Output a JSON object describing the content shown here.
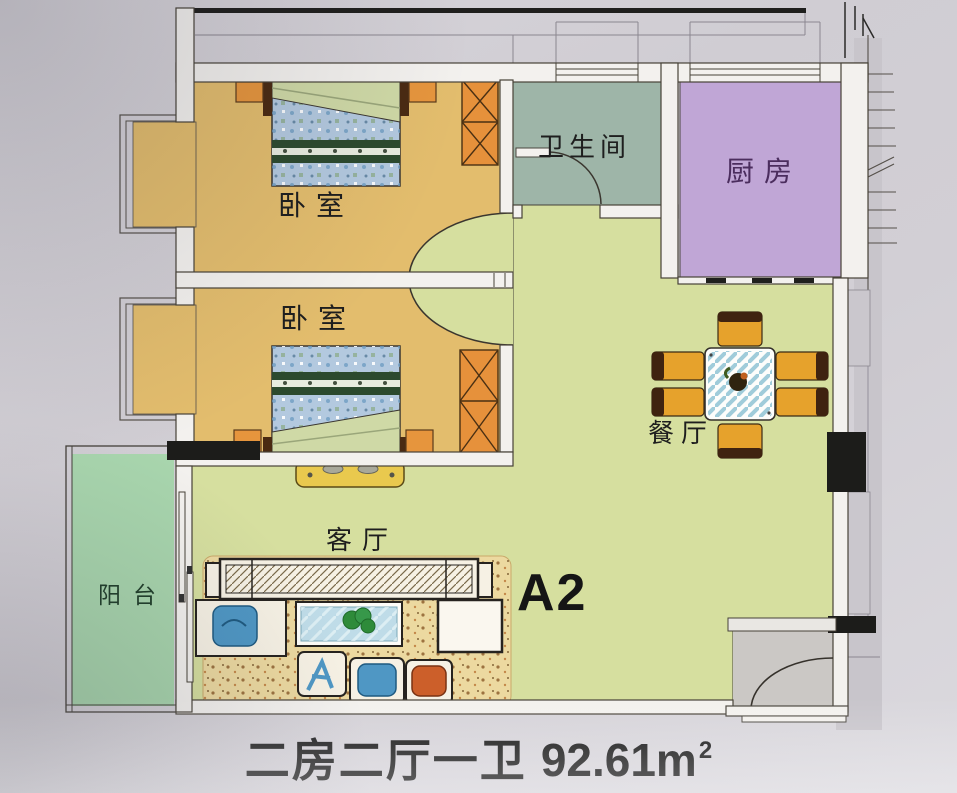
{
  "floor_plan": {
    "unit_label": "A2",
    "caption": {
      "layout": "二房二厅一卫",
      "area": "92.61m",
      "area_sup": "2"
    },
    "rooms": {
      "bedroom_top": {
        "label": "卧室"
      },
      "bedroom_bottom": {
        "label": "卧室"
      },
      "bathroom": {
        "label": "卫生间"
      },
      "kitchen": {
        "label": "厨房"
      },
      "dining": {
        "label": "餐厅"
      },
      "living": {
        "label": "客厅"
      },
      "balcony": {
        "label": "阳台"
      }
    },
    "colors": {
      "bedroom": "#e3bd6d",
      "living_dining": "#d6df9f",
      "bathroom": "#9eb5a8",
      "kitchen": "#c0a6d6",
      "balcony": "#a8d5ad",
      "wardrobe": "#e6913b",
      "dining_chair": "#e6a22c",
      "wall_black": "#1c1c1a",
      "paper": "#d2cfd5"
    }
  }
}
